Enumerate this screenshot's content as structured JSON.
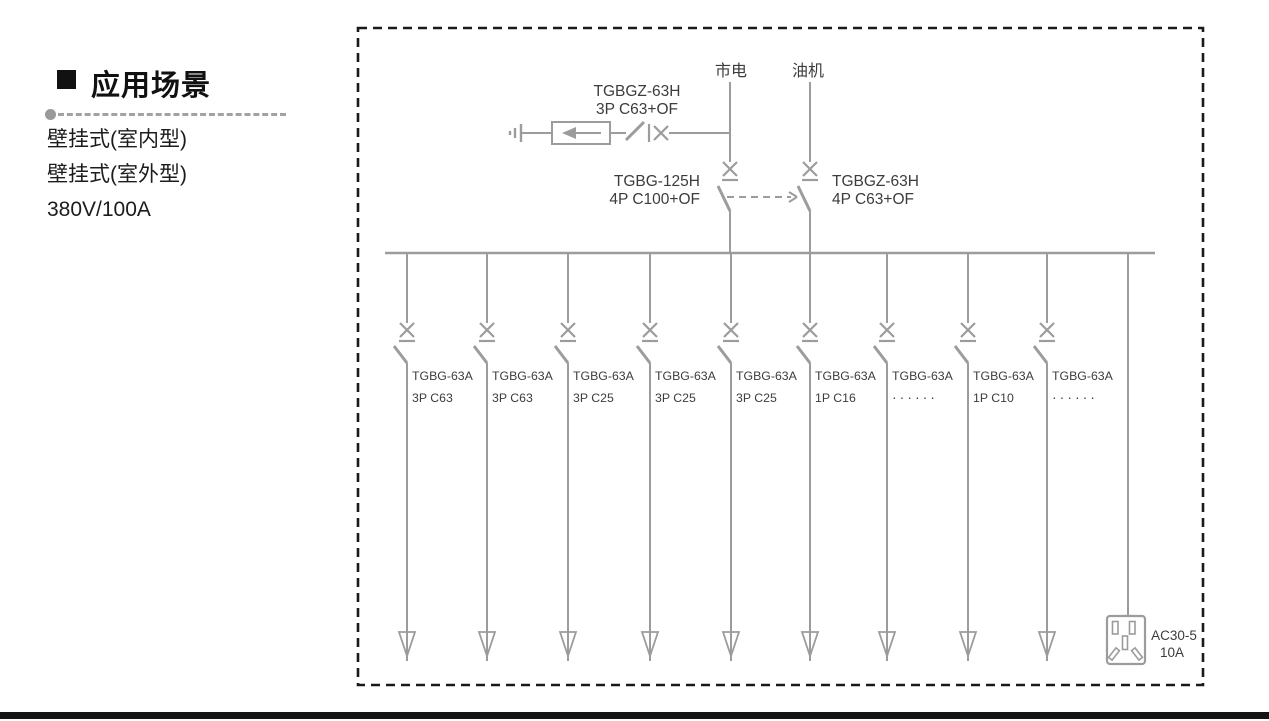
{
  "left_panel": {
    "heading": "应用场景",
    "items": [
      "壁挂式(室内型)",
      "壁挂式(室外型)",
      "380V/100A"
    ]
  },
  "diagram": {
    "mains_label": "市电",
    "generator_label": "油机",
    "spd_breaker": {
      "model": "TGBGZ-63H",
      "rating": "3P C63+OF"
    },
    "mains_breaker": {
      "model": "TGBG-125H",
      "rating": "4P C100+OF"
    },
    "generator_breaker": {
      "model": "TGBGZ-63H",
      "rating": "4P C63+OF"
    },
    "feeders": [
      {
        "model": "TGBG-63A",
        "rating": "3P C63"
      },
      {
        "model": "TGBG-63A",
        "rating": "3P C63"
      },
      {
        "model": "TGBG-63A",
        "rating": "3P C25"
      },
      {
        "model": "TGBG-63A",
        "rating": "3P C25"
      },
      {
        "model": "TGBG-63A",
        "rating": "3P C25"
      },
      {
        "model": "TGBG-63A",
        "rating": "1P C16"
      },
      {
        "model": "TGBG-63A",
        "rating": "······"
      },
      {
        "model": "TGBG-63A",
        "rating": "1P C10"
      },
      {
        "model": "TGBG-63A",
        "rating": "······"
      }
    ],
    "socket": {
      "model": "AC30-5",
      "rating": "10A"
    }
  },
  "colors": {
    "diagram_line": "#9c9c9c",
    "diagram_text": "#3c3c3c",
    "border_dash": "#1a1a1a",
    "left_text": "#1c1c1c",
    "bottom_bar": "#141414"
  }
}
